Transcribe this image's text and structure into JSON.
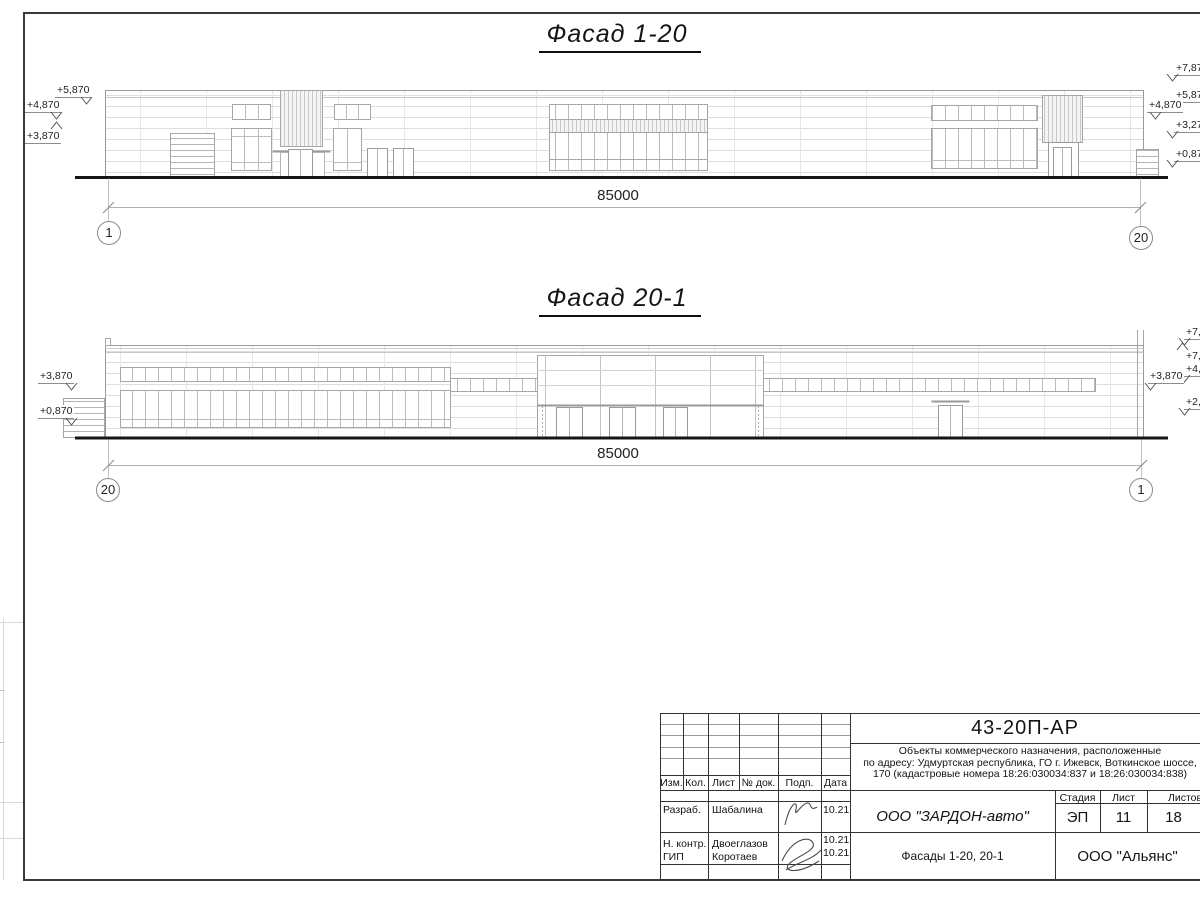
{
  "sheet": {
    "facade1": {
      "title": "Фасад 1-20",
      "dim": "85000",
      "axis_left": "1",
      "axis_right": "20",
      "marks_left": [
        "+5,870",
        "+4,870",
        "+3,870"
      ],
      "marks_right": [
        "+7,870",
        "+5,870",
        "+4,870",
        "+3,270",
        "+0,870"
      ]
    },
    "facade2": {
      "title": "Фасад 20-1",
      "dim": "85000",
      "axis_left": "20",
      "axis_right": "1",
      "marks_left": [
        "+3,870",
        "+0,870"
      ],
      "marks_right": [
        "+7,870",
        "+7,870",
        "+4,870",
        "+3,870",
        "+2,170"
      ]
    }
  },
  "titleblock": {
    "doc_number": "43-20П-АР",
    "description": [
      "Объекты коммерческого назначения, расположенные",
      "по адресу: Удмуртская республика, ГО г. Ижевск, Воткинское шоссе,",
      "170 (кадастровые номера 18:26:030034:837 и 18:26:030034:838)"
    ],
    "headers": {
      "izm": "Изм.",
      "kol": "Кол.",
      "list": "Лист",
      "doc": "№ док.",
      "podp": "Подп.",
      "date": "Дата",
      "stage": "Стадия",
      "sheet": "Лист",
      "sheets": "Листов"
    },
    "rows": [
      {
        "role": "Разраб.",
        "name": "Шабалина",
        "date": "10.21"
      },
      {
        "role": "Н. контр.",
        "name": "Двоеглазов",
        "date": "10.21"
      },
      {
        "role": "ГИП",
        "name": "Коротаев",
        "date": "10.21"
      }
    ],
    "company": "ООО \"ЗАРДОН-авто\"",
    "sheet_title": "Фасады 1-20, 20-1",
    "stage": "ЭП",
    "sheet_no": "11",
    "sheets_total": "18",
    "org": "ООО \"Альянс\""
  }
}
